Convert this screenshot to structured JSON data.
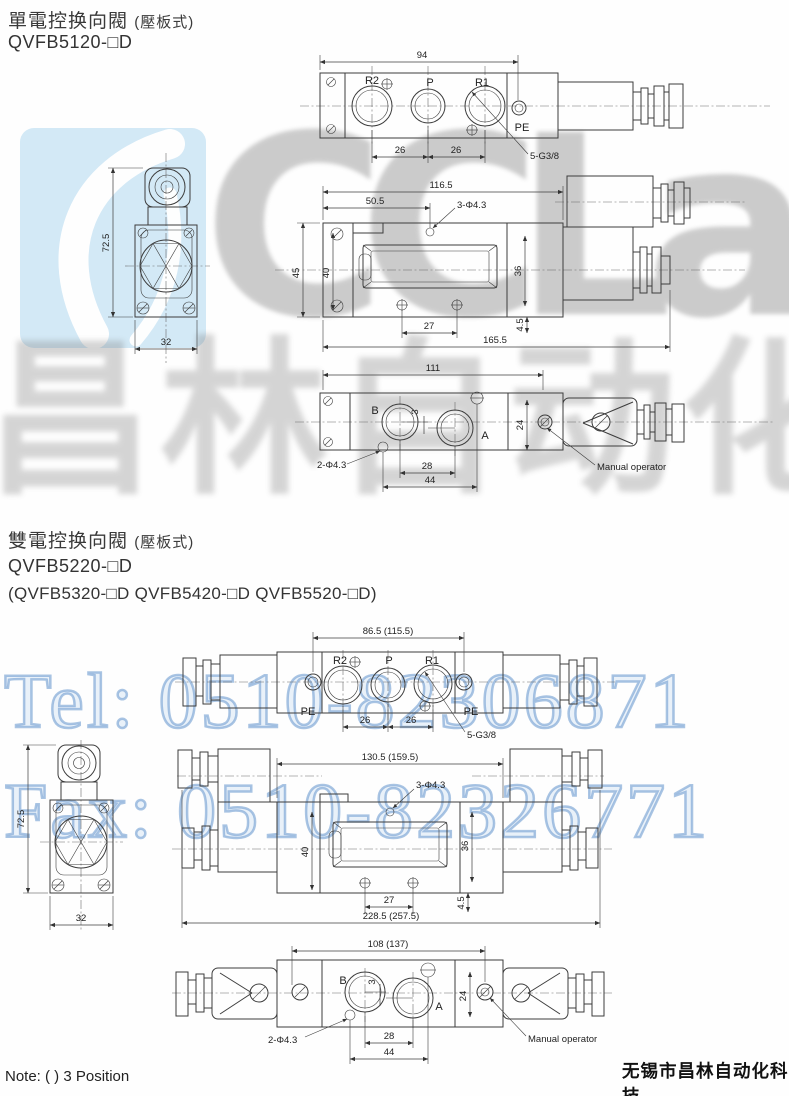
{
  "page": {
    "note": "Note: ( ) 3 Position",
    "company": "无锡市昌林自动化科技"
  },
  "watermark": {
    "logo_gray": "CCLa",
    "logo_blue": "ir",
    "cn": "昌林自动化",
    "tel": "Tel: 0510-82306871",
    "fax": "Fax: 0510-82326771",
    "colors": {
      "logo_block_blue": "#cfe7f6",
      "phone_blue": "#709dd0",
      "logo_gray_color": "#9a9a9a"
    }
  },
  "s1": {
    "title": "單電控换向閥",
    "title_note": "(壓板式)",
    "model": "QVFB5120-□D",
    "top": {
      "dim94": "94",
      "r2": "R2",
      "p": "P",
      "r1": "R1",
      "pe": "PE",
      "dim26a": "26",
      "dim26b": "26",
      "thread": "5-G3/8"
    },
    "side": {
      "dim1165": "116.5",
      "dim505": "50.5",
      "holes": "3-Φ4.3",
      "dim45": "45",
      "dim40": "40",
      "dim36": "36",
      "dim27": "27",
      "dim45b": "4.5",
      "dim1655": "165.5"
    },
    "bottom": {
      "dim111": "111",
      "b": "B",
      "a": "A",
      "dim3": "3",
      "dim24": "24",
      "dim28": "28",
      "dim44": "44",
      "holes": "2-Φ4.3",
      "manual": "Manual operator"
    },
    "end": {
      "dim725": "72.5",
      "dim32": "32"
    }
  },
  "s2": {
    "title": "雙電控换向閥",
    "title_note": "(壓板式)",
    "model": "QVFB5220-□D",
    "models_alt": "(QVFB5320-□D  QVFB5420-□D  QVFB5520-□D)",
    "top": {
      "dimw": "86.5 (115.5)",
      "pel": "PE",
      "r2": "R2",
      "p": "P",
      "r1": "R1",
      "per": "PE",
      "dim26a": "26",
      "dim26b": "26",
      "thread": "5-G3/8"
    },
    "side": {
      "dimw": "130.5 (159.5)",
      "holes": "3-Φ4.3",
      "dim40": "40",
      "dim36": "36",
      "dim27": "27",
      "dim45": "4.5",
      "dimtotal": "228.5 (257.5)"
    },
    "bottom": {
      "dimw": "108 (137)",
      "b": "B",
      "a": "A",
      "dim3": "3",
      "dim24": "24",
      "dim28": "28",
      "dim44": "44",
      "holes": "2-Φ4.3",
      "manual": "Manual operator"
    },
    "end": {
      "dim725": "72.5",
      "dim32": "32"
    }
  }
}
